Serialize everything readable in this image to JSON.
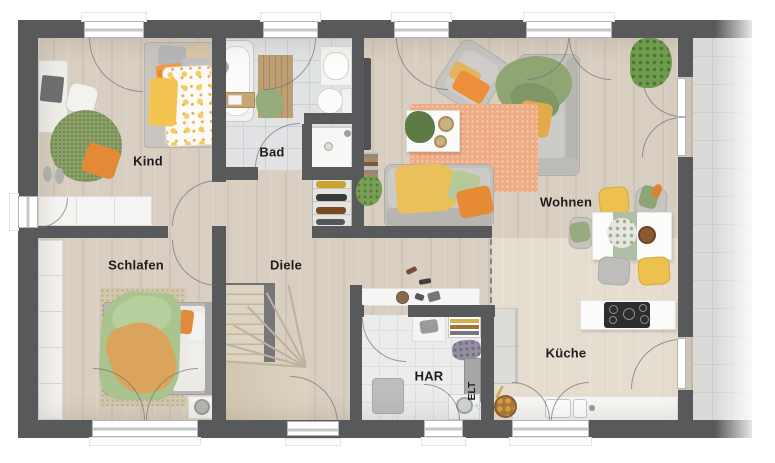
{
  "rooms": {
    "kind": {
      "label": "Kind"
    },
    "bad": {
      "label": "Bad"
    },
    "wohnen": {
      "label": "Wohnen"
    },
    "schlafen": {
      "label": "Schlafen"
    },
    "diele": {
      "label": "Diele"
    },
    "har": {
      "label": "HAR"
    },
    "elt": {
      "label": "ELT"
    },
    "kueche": {
      "label": "Küche"
    }
  },
  "palette": {
    "wall": "#58595b",
    "wood_floor": "#d8cec1",
    "bath_tile": "#e0e2e4",
    "utility_tile": "#ebeced",
    "terrace_tile": "#dadad8",
    "stair_wood": "#d8cdb9",
    "rug_living": "#eeab81",
    "rug_child": "#8ca26a",
    "rug_bedroom": "#d3c8ad",
    "accent_orange": "#e78a35",
    "accent_yellow": "#ecc14f",
    "accent_green": "#8fa673"
  }
}
